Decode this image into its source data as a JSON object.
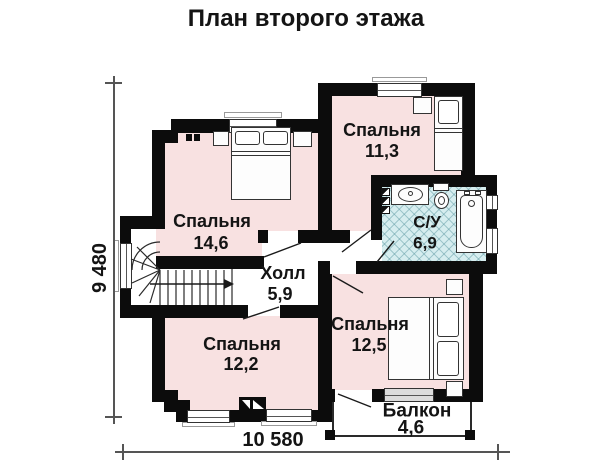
{
  "title": "План второго этажа",
  "plan": {
    "rooms": [
      {
        "id": "bedroom-1",
        "name": "Спальня",
        "area": "14,6"
      },
      {
        "id": "bedroom-2",
        "name": "Спальня",
        "area": "11,3"
      },
      {
        "id": "bathroom",
        "name": "С/У",
        "area": "6,9"
      },
      {
        "id": "hall",
        "name": "Холл",
        "area": "5,9"
      },
      {
        "id": "bedroom-3",
        "name": "Спальня",
        "area": "12,5"
      },
      {
        "id": "bedroom-4",
        "name": "Спальня",
        "area": "12,2"
      },
      {
        "id": "balcony",
        "name": "Балкон",
        "area": "4,6"
      }
    ],
    "dimensions": {
      "height_mm": "9 480",
      "width_mm": "10 580"
    },
    "fixtures": [
      "double-bed",
      "single-bed",
      "double-bed",
      "winder-staircase",
      "sink",
      "toilet",
      "bathtub",
      "vent-shaft",
      "chimney"
    ],
    "colors": {
      "wall": "#0c0c0c",
      "room_floor": "#f8e1e1",
      "tile_floor": "#d6edef",
      "background": "#ffffff"
    }
  }
}
